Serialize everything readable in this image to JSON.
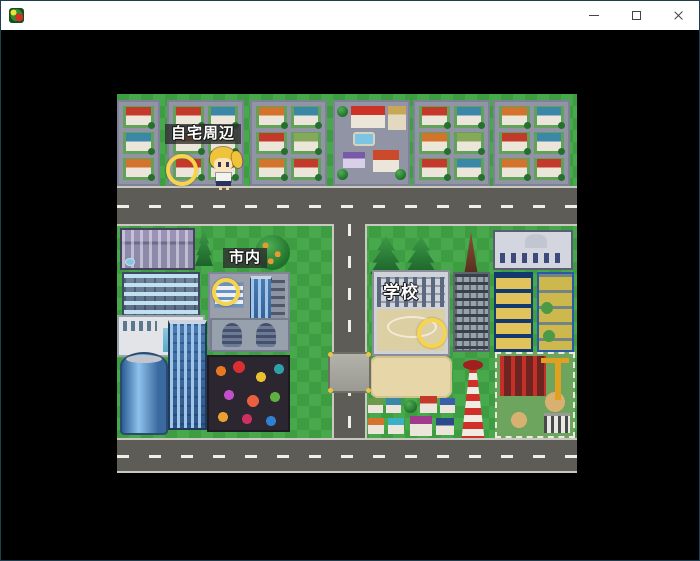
{
  "window": {
    "title": "",
    "icon": "rpg-maker-game-icon",
    "controls": {
      "minimize": "minimize-window",
      "maximize": "maximize-window",
      "close": "close-window"
    }
  },
  "game": {
    "scene": "town-map-area-select",
    "labels": {
      "home": "自宅周辺",
      "city": "市内",
      "school": "学校"
    },
    "markers": [
      {
        "name": "home-marker",
        "shape": "yellow-ring"
      },
      {
        "name": "city-marker",
        "shape": "yellow-ring"
      },
      {
        "name": "school-marker",
        "shape": "yellow-ring"
      }
    ],
    "player": "blonde-girl-sprite",
    "colors": {
      "grass": "#3e9c43",
      "road": "#5d5c57",
      "block_pavement": "#9094a4",
      "label_bg": "rgba(45,45,45,0.78)",
      "marker_yellow": "#f6d44c",
      "screen_bg": "#000000",
      "titlebar_bg": "#ffffff"
    }
  }
}
